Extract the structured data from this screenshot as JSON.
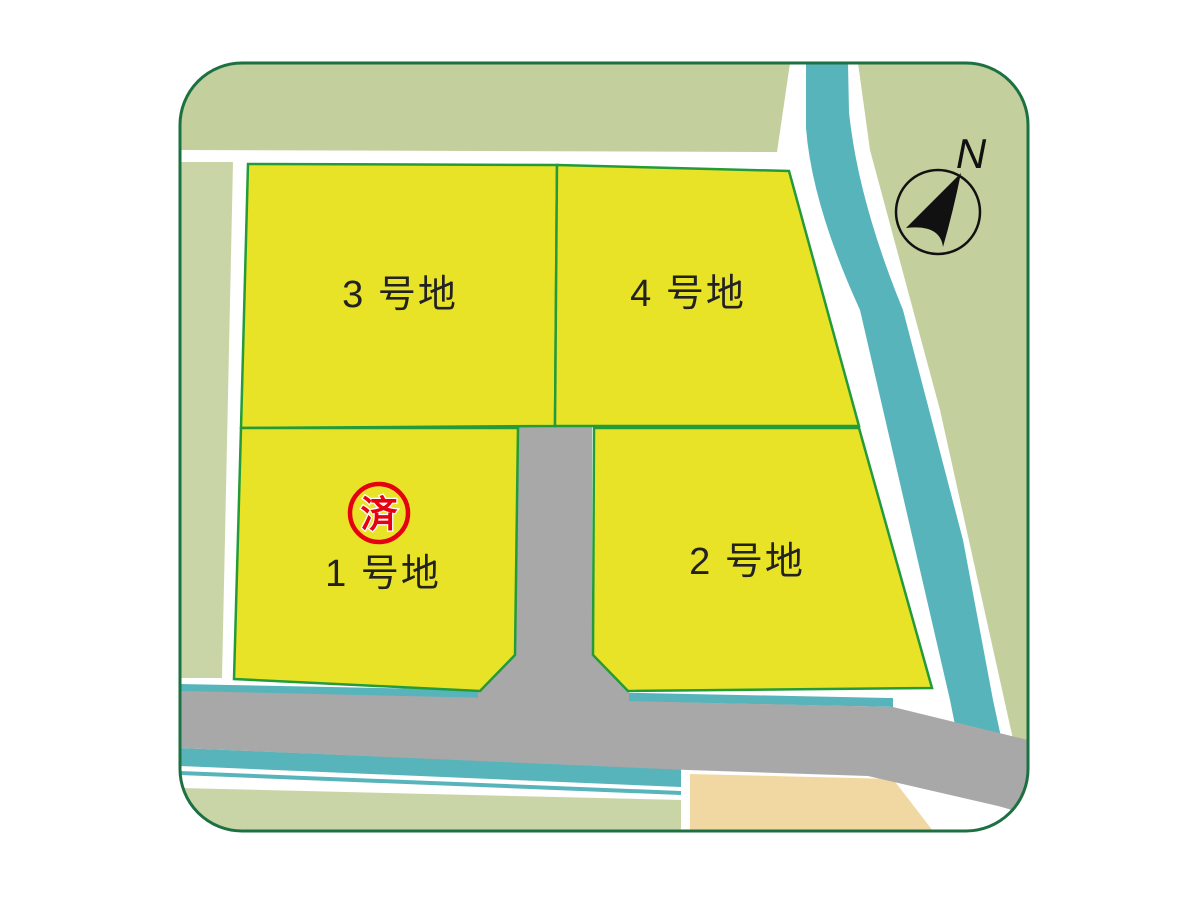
{
  "map": {
    "compass": {
      "label": "N"
    },
    "lots": [
      {
        "id": "lot-1",
        "label": "1 号地",
        "sold": true
      },
      {
        "id": "lot-2",
        "label": "2 号地",
        "sold": false
      },
      {
        "id": "lot-3",
        "label": "3 号地",
        "sold": false
      },
      {
        "id": "lot-4",
        "label": "4 号地",
        "sold": false
      }
    ],
    "sold_badge": {
      "label": "済"
    },
    "colors": {
      "background_green": "#c3cf9c",
      "background_green_light": "#cad5a7",
      "lot_yellow": "#e9e327",
      "lot_border_green": "#239b3a",
      "water_teal": "#58b4bb",
      "road_gray": "#a9a8a9",
      "field_beige": "#f1d8a2",
      "outline_dark_green": "#1b7141",
      "badge_red": "#e50012",
      "text_color": "#222222",
      "base_white": "#ffffff"
    }
  }
}
